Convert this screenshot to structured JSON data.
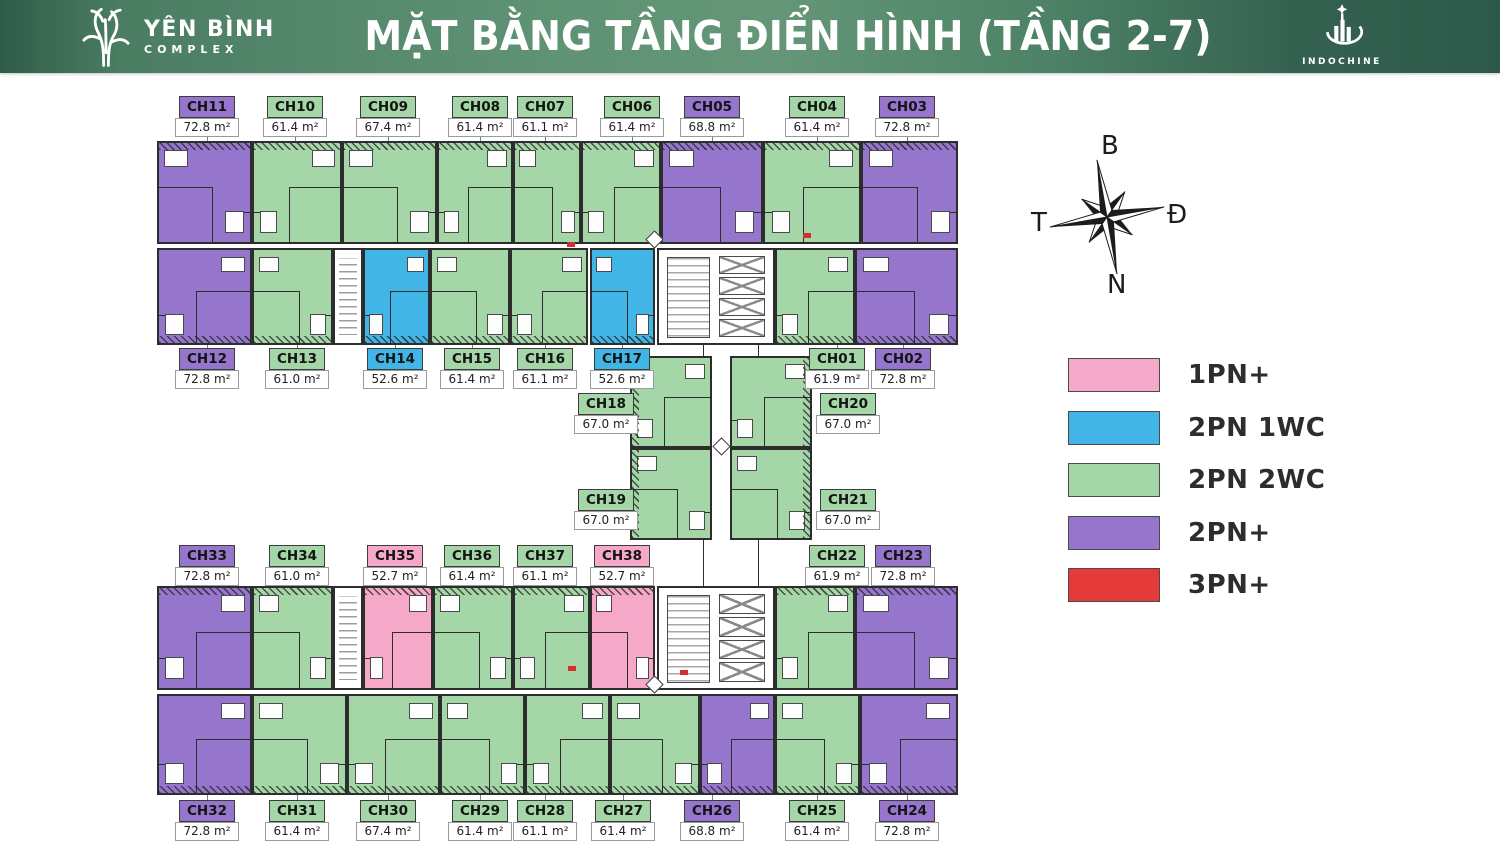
{
  "header": {
    "brand": {
      "name": "YÊN BÌNH",
      "subtitle": "COMPLEX"
    },
    "title": "MẶT BẰNG TẦNG ĐIỂN HÌNH (TẦNG 2-7)",
    "partner": "INDOCHINE"
  },
  "compass": {
    "north_label": "B",
    "east_label": "Đ",
    "south_label": "N",
    "west_label": "T"
  },
  "legend": {
    "items": [
      {
        "label": "1PN+",
        "color": "#f6a8c9"
      },
      {
        "label": "2PN 1WC",
        "color": "#41b6e6"
      },
      {
        "label": "2PN 2WC",
        "color": "#a5d6a7"
      },
      {
        "label": "2PN+",
        "color": "#9576cc"
      },
      {
        "label": "3PN+",
        "color": "#e53a3a"
      }
    ]
  },
  "unit_types": {
    "1PN+": "#f6a8c9",
    "2PN 1WC": "#41b6e6",
    "2PN 2WC": "#a5d6a7",
    "2PN+": "#9576cc",
    "3PN+": "#e53a3a"
  },
  "units": [
    {
      "code": "CH11",
      "area": "72.8 m²",
      "type": "2PN+",
      "rect": [
        157,
        141,
        95,
        103
      ],
      "label": {
        "cx": 207,
        "y": 96,
        "side": "above"
      },
      "hatch": "t"
    },
    {
      "code": "CH10",
      "area": "61.4 m²",
      "type": "2PN 2WC",
      "rect": [
        252,
        141,
        90,
        103
      ],
      "label": {
        "cx": 295,
        "y": 96,
        "side": "above"
      },
      "hatch": "t"
    },
    {
      "code": "CH09",
      "area": "67.4 m²",
      "type": "2PN 2WC",
      "rect": [
        342,
        141,
        95,
        103
      ],
      "label": {
        "cx": 388,
        "y": 96,
        "side": "above"
      },
      "hatch": "t"
    },
    {
      "code": "CH08",
      "area": "61.4 m²",
      "type": "2PN 2WC",
      "rect": [
        437,
        141,
        76,
        103
      ],
      "label": {
        "cx": 480,
        "y": 96,
        "side": "above"
      },
      "hatch": "t"
    },
    {
      "code": "CH07",
      "area": "61.1 m²",
      "type": "2PN 2WC",
      "rect": [
        513,
        141,
        68,
        103
      ],
      "label": {
        "cx": 545,
        "y": 96,
        "side": "above"
      },
      "hatch": "t"
    },
    {
      "code": "CH06",
      "area": "61.4 m²",
      "type": "2PN 2WC",
      "rect": [
        581,
        141,
        80,
        103
      ],
      "label": {
        "cx": 632,
        "y": 96,
        "side": "above"
      },
      "hatch": "t"
    },
    {
      "code": "CH05",
      "area": "68.8 m²",
      "type": "2PN+",
      "rect": [
        661,
        141,
        102,
        103
      ],
      "label": {
        "cx": 712,
        "y": 96,
        "side": "above"
      },
      "hatch": "t"
    },
    {
      "code": "CH04",
      "area": "61.4 m²",
      "type": "2PN 2WC",
      "rect": [
        763,
        141,
        98,
        103
      ],
      "label": {
        "cx": 817,
        "y": 96,
        "side": "above"
      },
      "hatch": "t"
    },
    {
      "code": "CH03",
      "area": "72.8 m²",
      "type": "2PN+",
      "rect": [
        861,
        141,
        97,
        103
      ],
      "label": {
        "cx": 907,
        "y": 96,
        "side": "above"
      },
      "hatch": "t"
    },
    {
      "code": "CH12",
      "area": "72.8 m²",
      "type": "2PN+",
      "rect": [
        157,
        248,
        95,
        97
      ],
      "label": {
        "cx": 207,
        "y": 348,
        "side": "below"
      },
      "hatch": "b"
    },
    {
      "code": "CH13",
      "area": "61.0 m²",
      "type": "2PN 2WC",
      "rect": [
        252,
        248,
        81,
        97
      ],
      "label": {
        "cx": 297,
        "y": 348,
        "side": "below"
      },
      "hatch": "b"
    },
    {
      "code": "CH14",
      "area": "52.6 m²",
      "type": "2PN 1WC",
      "rect": [
        363,
        248,
        67,
        97
      ],
      "label": {
        "cx": 395,
        "y": 348,
        "side": "below"
      },
      "hatch": "b"
    },
    {
      "code": "CH15",
      "area": "61.4 m²",
      "type": "2PN 2WC",
      "rect": [
        430,
        248,
        80,
        97
      ],
      "label": {
        "cx": 472,
        "y": 348,
        "side": "below"
      },
      "hatch": "b"
    },
    {
      "code": "CH16",
      "area": "61.1 m²",
      "type": "2PN 2WC",
      "rect": [
        510,
        248,
        78,
        97
      ],
      "label": {
        "cx": 545,
        "y": 348,
        "side": "below"
      },
      "hatch": "b"
    },
    {
      "code": "CH17",
      "area": "52.6 m²",
      "type": "2PN 1WC",
      "rect": [
        590,
        248,
        65,
        97
      ],
      "label": {
        "cx": 622,
        "y": 348,
        "side": "below"
      },
      "hatch": "b"
    },
    {
      "code": "CH01",
      "area": "61.9 m²",
      "type": "2PN 2WC",
      "rect": [
        775,
        248,
        80,
        97
      ],
      "label": {
        "cx": 837,
        "y": 348,
        "side": "below"
      },
      "hatch": "b"
    },
    {
      "code": "CH02",
      "area": "72.8 m²",
      "type": "2PN+",
      "rect": [
        855,
        248,
        103,
        97
      ],
      "label": {
        "cx": 903,
        "y": 348,
        "side": "below"
      },
      "hatch": "b"
    },
    {
      "code": "CH18",
      "area": "67.0 m²",
      "type": "2PN 2WC",
      "rect": [
        630,
        356,
        82,
        92
      ],
      "label": {
        "cx": 606,
        "y": 393,
        "side": "left"
      },
      "hatch": "l"
    },
    {
      "code": "CH19",
      "area": "67.0 m²",
      "type": "2PN 2WC",
      "rect": [
        630,
        448,
        82,
        92
      ],
      "label": {
        "cx": 606,
        "y": 489,
        "side": "left"
      },
      "hatch": "l"
    },
    {
      "code": "CH20",
      "area": "67.0 m²",
      "type": "2PN 2WC",
      "rect": [
        730,
        356,
        82,
        92
      ],
      "label": {
        "cx": 848,
        "y": 393,
        "side": "right"
      },
      "hatch": "r"
    },
    {
      "code": "CH21",
      "area": "67.0 m²",
      "type": "2PN 2WC",
      "rect": [
        730,
        448,
        82,
        92
      ],
      "label": {
        "cx": 848,
        "y": 489,
        "side": "right"
      },
      "hatch": "r"
    },
    {
      "code": "CH33",
      "area": "72.8 m²",
      "type": "2PN+",
      "rect": [
        157,
        586,
        95,
        104
      ],
      "label": {
        "cx": 207,
        "y": 545,
        "side": "above"
      },
      "hatch": "t"
    },
    {
      "code": "CH34",
      "area": "61.0 m²",
      "type": "2PN 2WC",
      "rect": [
        252,
        586,
        81,
        104
      ],
      "label": {
        "cx": 297,
        "y": 545,
        "side": "above"
      },
      "hatch": "t"
    },
    {
      "code": "CH35",
      "area": "52.7 m²",
      "type": "1PN+",
      "rect": [
        363,
        586,
        70,
        104
      ],
      "label": {
        "cx": 395,
        "y": 545,
        "side": "above"
      },
      "hatch": "t"
    },
    {
      "code": "CH36",
      "area": "61.4 m²",
      "type": "2PN 2WC",
      "rect": [
        433,
        586,
        80,
        104
      ],
      "label": {
        "cx": 472,
        "y": 545,
        "side": "above"
      },
      "hatch": "t"
    },
    {
      "code": "CH37",
      "area": "61.1 m²",
      "type": "2PN 2WC",
      "rect": [
        513,
        586,
        77,
        104
      ],
      "label": {
        "cx": 545,
        "y": 545,
        "side": "above"
      },
      "hatch": "t"
    },
    {
      "code": "CH38",
      "area": "52.7 m²",
      "type": "1PN+",
      "rect": [
        590,
        586,
        65,
        104
      ],
      "label": {
        "cx": 622,
        "y": 545,
        "side": "above"
      },
      "hatch": "t"
    },
    {
      "code": "CH22",
      "area": "61.9 m²",
      "type": "2PN 2WC",
      "rect": [
        775,
        586,
        80,
        104
      ],
      "label": {
        "cx": 837,
        "y": 545,
        "side": "above"
      },
      "hatch": "t"
    },
    {
      "code": "CH23",
      "area": "72.8 m²",
      "type": "2PN+",
      "rect": [
        855,
        586,
        103,
        104
      ],
      "label": {
        "cx": 903,
        "y": 545,
        "side": "above"
      },
      "hatch": "t"
    },
    {
      "code": "CH32",
      "area": "72.8 m²",
      "type": "2PN+",
      "rect": [
        157,
        694,
        95,
        101
      ],
      "label": {
        "cx": 207,
        "y": 800,
        "side": "below"
      },
      "hatch": "b"
    },
    {
      "code": "CH31",
      "area": "61.4 m²",
      "type": "2PN 2WC",
      "rect": [
        252,
        694,
        95,
        101
      ],
      "label": {
        "cx": 297,
        "y": 800,
        "side": "below"
      },
      "hatch": "b"
    },
    {
      "code": "CH30",
      "area": "67.4 m²",
      "type": "2PN 2WC",
      "rect": [
        347,
        694,
        93,
        101
      ],
      "label": {
        "cx": 388,
        "y": 800,
        "side": "below"
      },
      "hatch": "b"
    },
    {
      "code": "CH29",
      "area": "61.4 m²",
      "type": "2PN 2WC",
      "rect": [
        440,
        694,
        85,
        101
      ],
      "label": {
        "cx": 480,
        "y": 800,
        "side": "below"
      },
      "hatch": "b"
    },
    {
      "code": "CH28",
      "area": "61.1 m²",
      "type": "2PN 2WC",
      "rect": [
        525,
        694,
        85,
        101
      ],
      "label": {
        "cx": 545,
        "y": 800,
        "side": "below"
      },
      "hatch": "b"
    },
    {
      "code": "CH27",
      "area": "61.4 m²",
      "type": "2PN 2WC",
      "rect": [
        610,
        694,
        90,
        101
      ],
      "label": {
        "cx": 623,
        "y": 800,
        "side": "below"
      },
      "hatch": "b"
    },
    {
      "code": "CH26",
      "area": "68.8 m²",
      "type": "2PN+",
      "rect": [
        700,
        694,
        75,
        101
      ],
      "label": {
        "cx": 712,
        "y": 800,
        "side": "below"
      },
      "hatch": "b"
    },
    {
      "code": "CH25",
      "area": "61.4 m²",
      "type": "2PN 2WC",
      "rect": [
        775,
        694,
        85,
        101
      ],
      "label": {
        "cx": 817,
        "y": 800,
        "side": "below"
      },
      "hatch": "b"
    },
    {
      "code": "CH24",
      "area": "72.8 m²",
      "type": "2PN+",
      "rect": [
        860,
        694,
        98,
        101
      ],
      "label": {
        "cx": 907,
        "y": 800,
        "side": "below"
      },
      "hatch": "b"
    }
  ]
}
